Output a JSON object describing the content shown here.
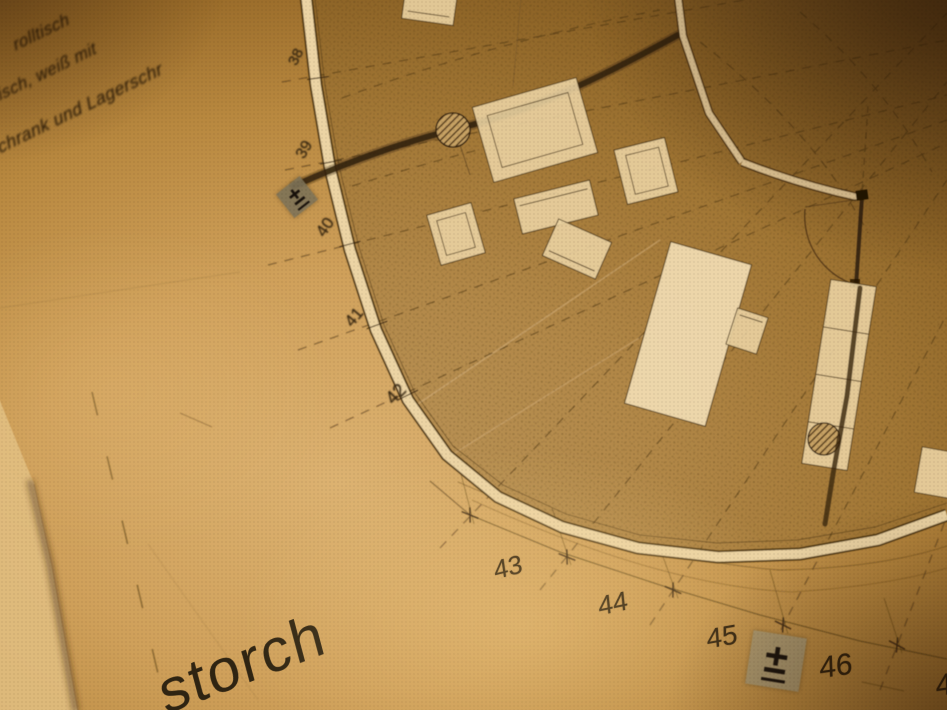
{
  "plan": {
    "grid_labels": [
      "38",
      "39",
      "40",
      "41",
      "42",
      "43",
      "44",
      "45",
      "46"
    ],
    "grid_label_partial": "4",
    "level_marker": "±",
    "legend_lines": [
      "rolltisch",
      "tisch, weiß mit",
      "schrank und Lagerschr"
    ],
    "signature": "storch"
  },
  "colors": {
    "paper_highlight": "#e8c98c",
    "paper_mid": "#c29149",
    "paper_shadow": "#5e3d14",
    "ink": "#3a2810",
    "floor_stipple": "#4e3812",
    "furniture_fill": "#ead1a1",
    "marker_square_dark": "#7d7258",
    "marker_square_light": "#a59a73"
  }
}
